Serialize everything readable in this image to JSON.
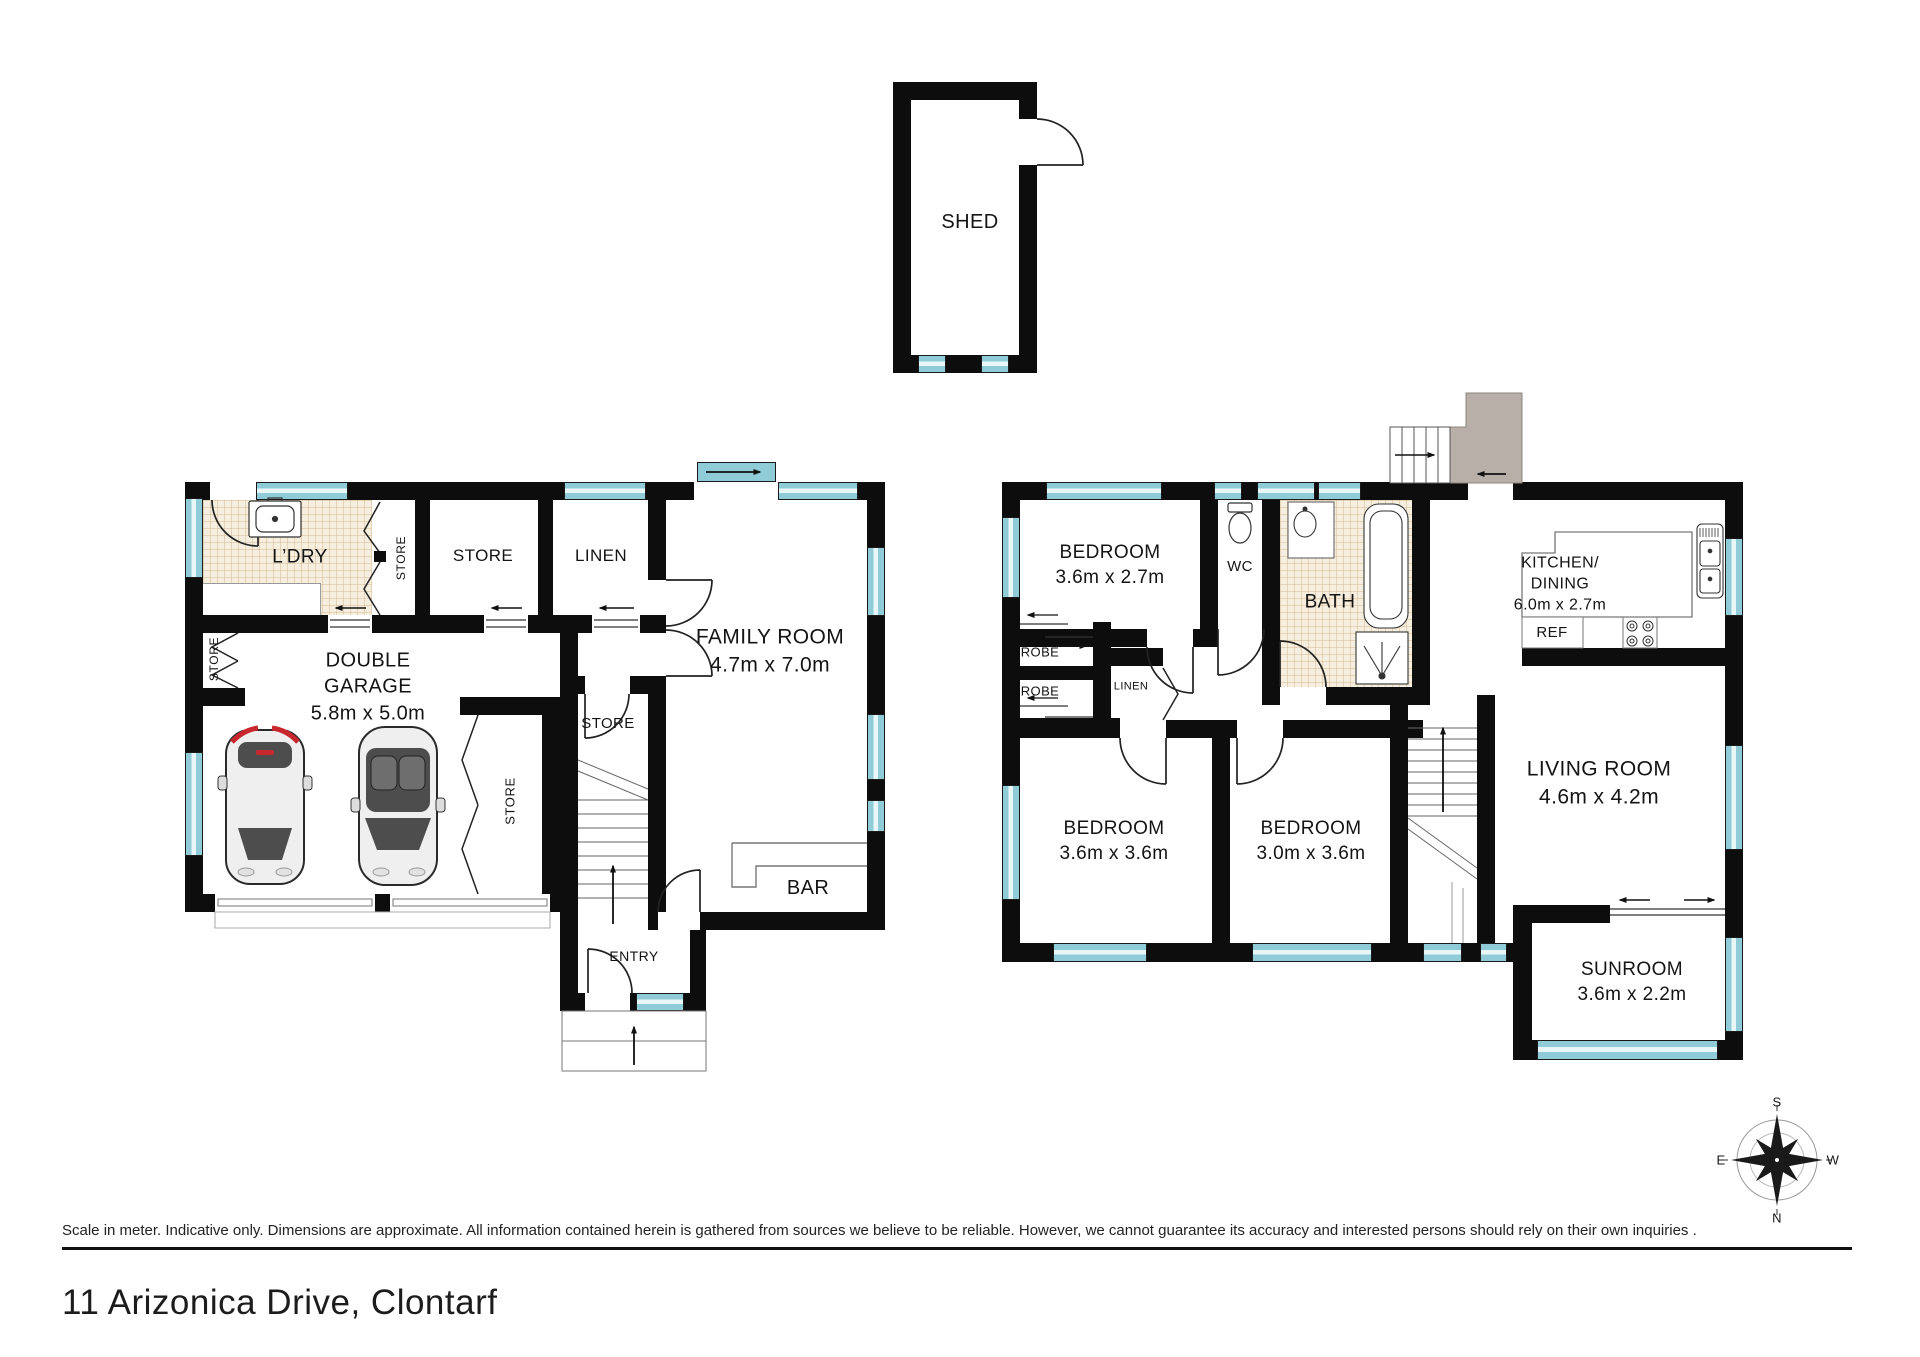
{
  "rooms": {
    "shed": {
      "name": "SHED"
    },
    "ldry": {
      "name": "L’DRY"
    },
    "store_bifold": {
      "name": "STORE"
    },
    "store_top": {
      "name": "STORE"
    },
    "linen_top": {
      "name": "LINEN"
    },
    "garage": {
      "name": "DOUBLE GARAGE",
      "dims": "5.8m x 5.0m"
    },
    "store_left": {
      "name": "STORE"
    },
    "store_garage": {
      "name": "STORE"
    },
    "store_mid": {
      "name": "STORE"
    },
    "family": {
      "name": "FAMILY ROOM",
      "dims": "4.7m x 7.0m"
    },
    "bar": {
      "name": "BAR"
    },
    "entry": {
      "name": "ENTRY"
    },
    "bedroom1": {
      "name": "BEDROOM",
      "dims": "3.6m x 2.7m"
    },
    "wc": {
      "name": "WC"
    },
    "bath": {
      "name": "BATH"
    },
    "kitchen": {
      "name_l1": "KITCHEN/",
      "name_l2": "DINING",
      "dims": "6.0m x 2.7m"
    },
    "ref": {
      "name": "REF"
    },
    "robe1": {
      "name": "ROBE"
    },
    "robe2": {
      "name": "ROBE"
    },
    "linen_hall": {
      "name": "LINEN"
    },
    "bedroom2": {
      "name": "BEDROOM",
      "dims": "3.6m x 3.6m"
    },
    "bedroom3": {
      "name": "BEDROOM",
      "dims": "3.0m x 3.6m"
    },
    "living": {
      "name": "LIVING ROOM",
      "dims": "4.6m x 4.2m"
    },
    "sunroom": {
      "name": "SUNROOM",
      "dims": "3.6m x 2.2m"
    }
  },
  "compass": {
    "north": "N",
    "south": "S",
    "east": "E",
    "west": "W"
  },
  "footer": {
    "disclaimer": "Scale in meter. Indicative only. Dimensions are approximate. All information contained herein is gathered from sources we believe to be reliable. However, we cannot guarantee its accuracy and interested persons should rely on their own inquiries .",
    "address": "11 Arizonica Drive, Clontarf"
  },
  "colors": {
    "wall": "#0d0d0d",
    "window": "#8fccd8",
    "tile_floor": "#f6eede",
    "landing": "#b9afa9",
    "car_accent": "#c8272d",
    "line": "#222222"
  }
}
